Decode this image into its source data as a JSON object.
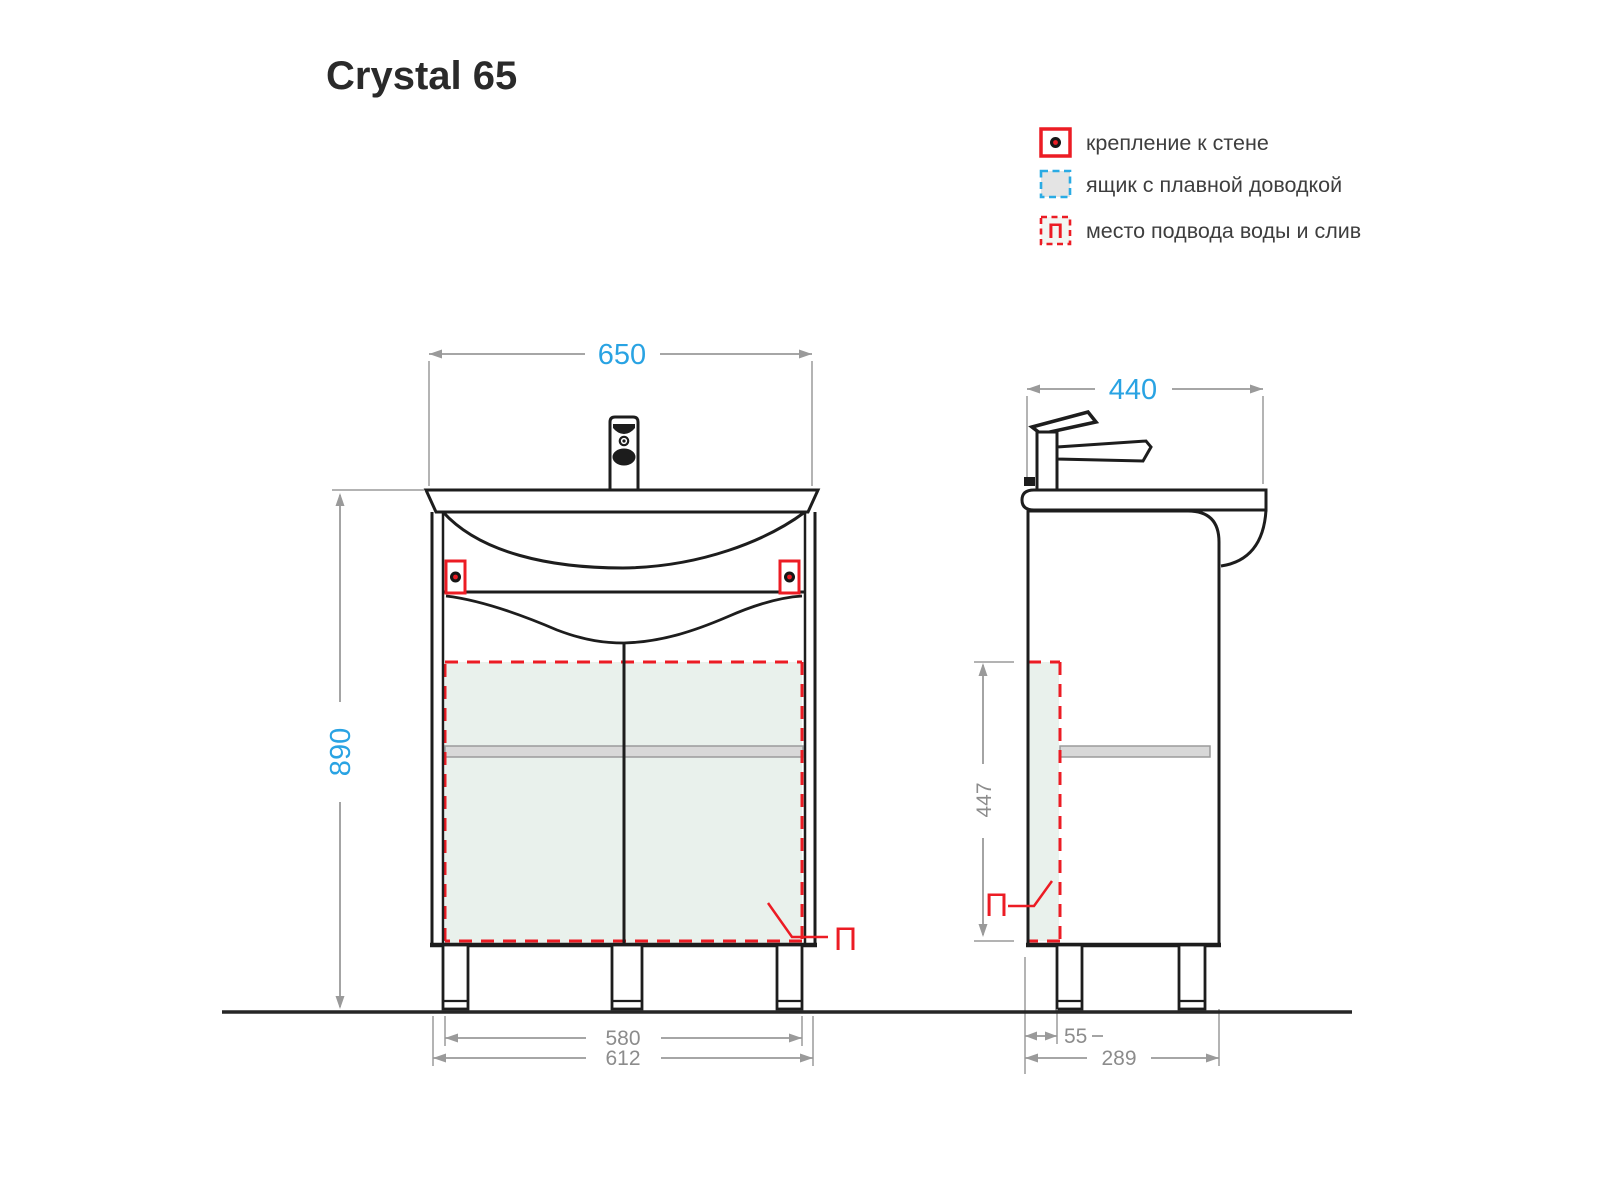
{
  "title": "Crystal 65",
  "legend": {
    "items": [
      {
        "label": "крепление к стене",
        "symbol": "wall-mount-marker"
      },
      {
        "label": "ящик с плавной доводкой",
        "symbol": "soft-close-drawer-swatch"
      },
      {
        "label": "место подвода воды и слив",
        "symbol": "water-drain-zone-swatch",
        "symbol_letter": "П"
      }
    ]
  },
  "front_view": {
    "width_mm": "650",
    "height_mm": "890",
    "legs_span_mm": "580",
    "base_width_mm": "612",
    "marker": "П"
  },
  "side_view": {
    "depth_mm": "440",
    "zone_height_mm": "447",
    "back_offset_mm": "55",
    "base_depth_mm": "289",
    "marker": "П"
  },
  "colors": {
    "accent_blue": "#29a3e3",
    "accent_red": "#ec1c24",
    "zone_green": "#e9f1ec",
    "dim_gray": "#8c8c8c",
    "shelf_gray": "#d8d8d8"
  }
}
